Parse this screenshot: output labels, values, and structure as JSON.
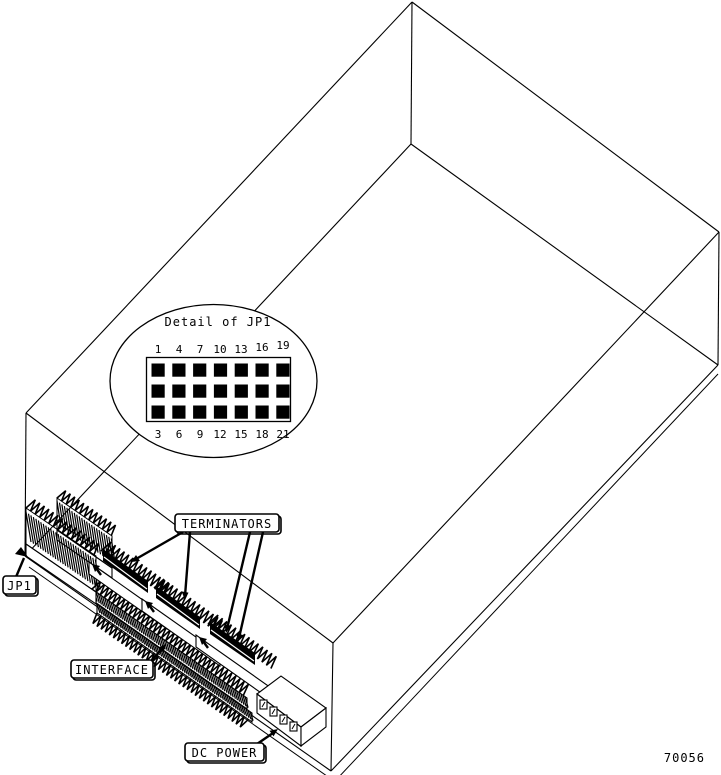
{
  "figure": {
    "detail_title": "Detail of JP1",
    "pins_top": [
      "1",
      "4",
      "7",
      "10",
      "13",
      "16",
      "19"
    ],
    "pins_bottom": [
      "3",
      "6",
      "9",
      "12",
      "15",
      "18",
      "21"
    ],
    "labels": {
      "jp1": "JP1",
      "terminators": "TERMINATORS",
      "interface": "INTERFACE",
      "dc_power": "DC POWER"
    },
    "figure_number": "70056",
    "colors": {
      "line": "#000000",
      "background": "#ffffff"
    }
  }
}
